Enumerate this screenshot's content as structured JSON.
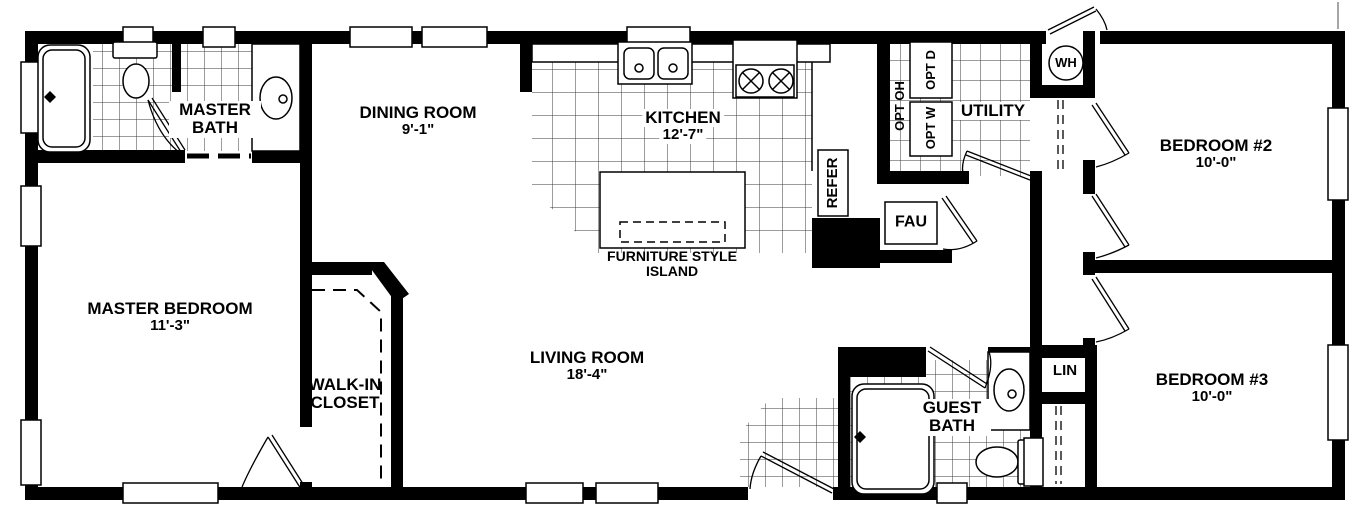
{
  "floorplan": {
    "rooms": {
      "master_bedroom": {
        "label": "MASTER BEDROOM",
        "dim": "11'-3\""
      },
      "master_bath": {
        "label": "MASTER BATH"
      },
      "walk_in_closet": {
        "label": "WALK-IN CLOSET"
      },
      "dining_room": {
        "label": "DINING ROOM",
        "dim": "9'-1\""
      },
      "kitchen": {
        "label": "KITCHEN",
        "dim": "12'-7\""
      },
      "living_room": {
        "label": "LIVING ROOM",
        "dim": "18'-4\""
      },
      "utility": {
        "label": "UTILITY"
      },
      "guest_bath": {
        "label": "GUEST BATH"
      },
      "bedroom_2": {
        "label": "BEDROOM #2",
        "dim": "10'-0\""
      },
      "bedroom_3": {
        "label": "BEDROOM #3",
        "dim": "10'-0\""
      }
    },
    "fixtures": {
      "island": {
        "label": "FURNITURE STYLE ISLAND"
      },
      "refrigerator": {
        "label": "REFER"
      },
      "furnace": {
        "label": "FAU"
      },
      "water_heater": {
        "label": "WH"
      },
      "linen": {
        "label": "LIN"
      },
      "opt_overhead": {
        "label": "OPT OH"
      },
      "opt_dryer": {
        "label": "OPT D"
      },
      "opt_washer": {
        "label": "OPT W"
      }
    },
    "colors": {
      "wall": "#000000",
      "background": "#ffffff"
    }
  }
}
